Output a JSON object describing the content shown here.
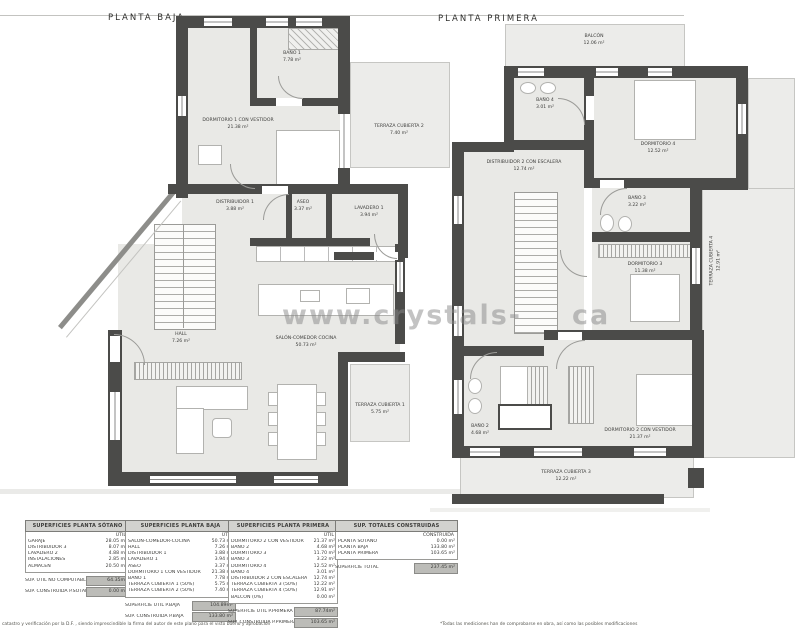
{
  "page": {
    "watermark_left": "www.crystals-",
    "watermark_right": "ca",
    "footer_left": "catastro y verificación por la D.F. , siendo imprescindible la firma del autor de este plano para el visto bueno y aprobación",
    "footer_right": "*Todas las mediciones han de comprobarse en obra, así como las posibles modificaciones"
  },
  "colors": {
    "wall": "#4b4b49",
    "room_fill": "#e9e9e6",
    "terrace_fill": "#ececea",
    "table_header_bg": "#d2d2cf",
    "total_cell_bg": "#bcbcb8"
  },
  "plans": {
    "baja": {
      "title": "PLANTA BAJA",
      "rooms": [
        {
          "name": "BAÑO 1",
          "area": "7.78 m²"
        },
        {
          "name": "DORMITORIO 1 CON VESTIDOR",
          "area": "21.38 m²"
        },
        {
          "name": "TERRAZA CUBIERTA 2",
          "area": "7.40 m²"
        },
        {
          "name": "DISTRIBUIDOR 1",
          "area": "3.88 m²"
        },
        {
          "name": "ASEO",
          "area": "3.37 m²"
        },
        {
          "name": "LAVADERO 1",
          "area": "3.94 m²"
        },
        {
          "name": "HALL",
          "area": "7.26 m²"
        },
        {
          "name": "SALÓN-COMEDOR COCINA",
          "area": "50.73 m²"
        },
        {
          "name": "TERRAZA CUBIERTA 1",
          "area": "5.75 m²"
        }
      ]
    },
    "primera": {
      "title": "PLANTA PRIMERA",
      "rooms": [
        {
          "name": "BALCÓN",
          "area": "12.06 m²"
        },
        {
          "name": "BAÑO 4",
          "area": "3.01 m²"
        },
        {
          "name": "DORMITORIO 4",
          "area": "12.52 m²"
        },
        {
          "name": "DISTRIBUIDOR 2 CON ESCALERA",
          "area": "12.74 m²"
        },
        {
          "name": "BAÑO 3",
          "area": "3.22 m²"
        },
        {
          "name": "DORMITORIO 3",
          "area": "11.38 m²"
        },
        {
          "name": "TERRAZA CUBIERTA 4",
          "area": "12.91 m²"
        },
        {
          "name": "BAÑO 2",
          "area": "4.68 m²"
        },
        {
          "name": "DORMITORIO 2 CON VESTIDOR",
          "area": "21.37 m²"
        },
        {
          "name": "TERRAZA CUBIERTA 3",
          "area": "12.22 m²"
        }
      ]
    }
  },
  "tables": [
    {
      "title": "SUPERFICIES PLANTA SÓTANO",
      "col": "ÚTIL",
      "rows": [
        {
          "label": "GARAJE",
          "value": "28.05 m²"
        },
        {
          "label": "DISTRIBUIDOR 3",
          "value": "8.07 m²"
        },
        {
          "label": "LAVADERO 2",
          "value": "4.88 m²"
        },
        {
          "label": "INSTALACIONES",
          "value": "2.85 m²"
        },
        {
          "label": "ALMACÉN",
          "value": "20.50 m²"
        }
      ],
      "totals": [
        {
          "label": "SUP. ÚTIL NO COMPUTABLE",
          "value": "64.35m²"
        },
        {
          "label": "SUP. CONSTRUIDA P.SÓTANO",
          "value": "0.00 m²"
        }
      ]
    },
    {
      "title": "SUPERFICIES PLANTA BAJA",
      "col": "ÚTIL",
      "rows": [
        {
          "label": "SALÓN-COMEDOR-COCINA",
          "value": "50.73 m²"
        },
        {
          "label": "HALL",
          "value": "7.26 m²"
        },
        {
          "label": "DISTRIBUIDOR 1",
          "value": "3.88 m²"
        },
        {
          "label": "LAVADERO 1",
          "value": "3.94 m²"
        },
        {
          "label": "ASEO",
          "value": "3.37 m²"
        },
        {
          "label": "DORMITORIO 1 CON VESTIDOR",
          "value": "21.38 m²"
        },
        {
          "label": "BAÑO 1",
          "value": "7.78 m²"
        },
        {
          "label": "TERRAZA CUBIERTA 1 (50%)",
          "value": "5.75 m²"
        },
        {
          "label": "TERRAZA CUBIERTA 2 (50%)",
          "value": "7.40 m²"
        }
      ],
      "totals": [
        {
          "label": "SUPERFICIE ÚTIL P.BAJA",
          "value": "104.89m²"
        },
        {
          "label": "SUP. CONSTRUIDA P.BAJA",
          "value": "133.80 m²"
        }
      ]
    },
    {
      "title": "SUPERFICIES PLANTA PRIMERA",
      "col": "ÚTIL",
      "rows": [
        {
          "label": "DORMITORIO 2 CON VESTIDOR",
          "value": "21.37 m²"
        },
        {
          "label": "BAÑO 2",
          "value": "4.68 m²"
        },
        {
          "label": "DORMITORIO 3",
          "value": "11.70 m²"
        },
        {
          "label": "BAÑO 3",
          "value": "3.22 m²"
        },
        {
          "label": "DORMITORIO 4",
          "value": "12.52 m²"
        },
        {
          "label": "BAÑO 4",
          "value": "3.01 m²"
        },
        {
          "label": "DISTRIBUIDOR 2 CON ESCALERA",
          "value": "12.74 m²"
        },
        {
          "label": "TERRAZA CUBIERTA 3 (50%)",
          "value": "12.22 m²"
        },
        {
          "label": "TERRAZA CUBIERTA 4 (50%)",
          "value": "12.91 m²"
        },
        {
          "label": "BALCÓN (0%)",
          "value": "0.00 m²"
        }
      ],
      "totals": [
        {
          "label": "SUPERFICIE ÚTIL P.PRIMERA",
          "value": "87.74m²"
        },
        {
          "label": "SUP. CONSTRUIDA P.PRIMERA",
          "value": "103.65 m²"
        }
      ]
    },
    {
      "title": "SUP. TOTALES CONSTRUIDAS",
      "col": "CONSTRUIDA",
      "rows": [
        {
          "label": "PLANTA SÓTANO",
          "value": "0.00 m²"
        },
        {
          "label": "PLANTA BAJA",
          "value": "133.80 m²"
        },
        {
          "label": "PLANTA PRIMERA",
          "value": "103.65 m²"
        }
      ],
      "totals": [
        {
          "label": "SUPERFICIE TOTAL",
          "value": "237.45 m²"
        }
      ]
    }
  ]
}
